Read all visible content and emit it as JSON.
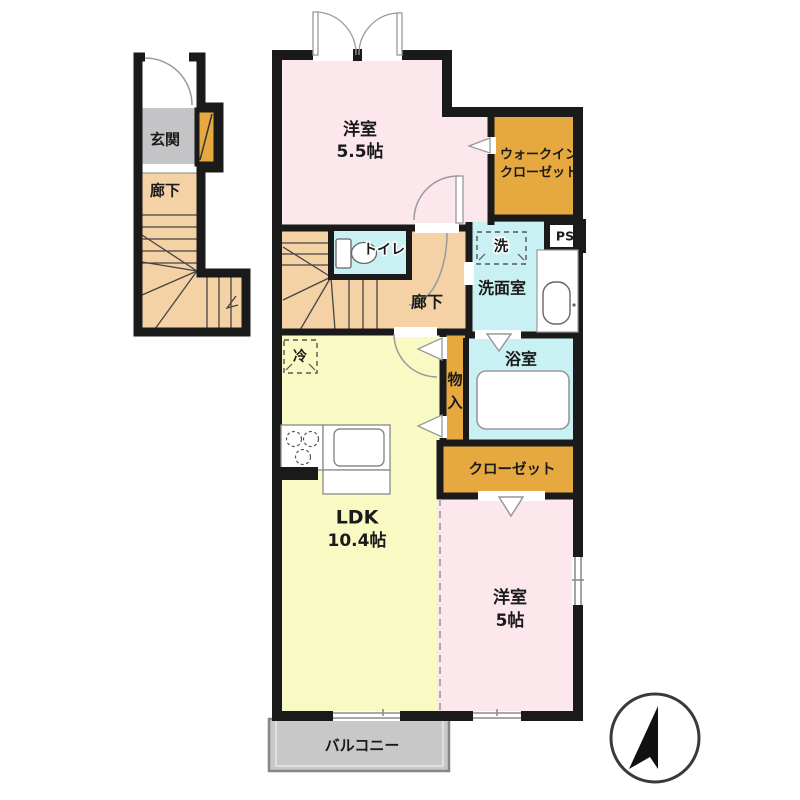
{
  "floorplan": {
    "annex": {
      "genkan": "玄関",
      "rouka": "廊下"
    },
    "rooms": {
      "yoshitsu55": {
        "name": "洋室",
        "size": "5.5帖"
      },
      "wic": {
        "line1": "ウォークイン",
        "line2": "クローゼット"
      },
      "toilet": "トイレ",
      "ps": "PS",
      "laundry": "洗",
      "senmenshitsu": "洗面室",
      "rouka": "廊下",
      "refrigerator": "冷",
      "monoire": {
        "char1": "物",
        "char2": "入"
      },
      "bathroom": "浴室",
      "closet": "クローゼット",
      "ldk": {
        "name": "LDK",
        "size": "10.4帖"
      },
      "yoshitsu5": {
        "name": "洋室",
        "size": "5帖"
      },
      "balcony": "バルコニー"
    },
    "colors": {
      "wall": "#1a1a1a",
      "room_pink": "#fce8ec",
      "room_yellow": "#f9f9c4",
      "corridor_peach": "#f4d2a6",
      "wet_cyan": "#c9f1f4",
      "closet_orange": "#e5a93f",
      "entrance_gray": "#c4c4c6",
      "balcony_gray": "#c8c8c8"
    }
  }
}
